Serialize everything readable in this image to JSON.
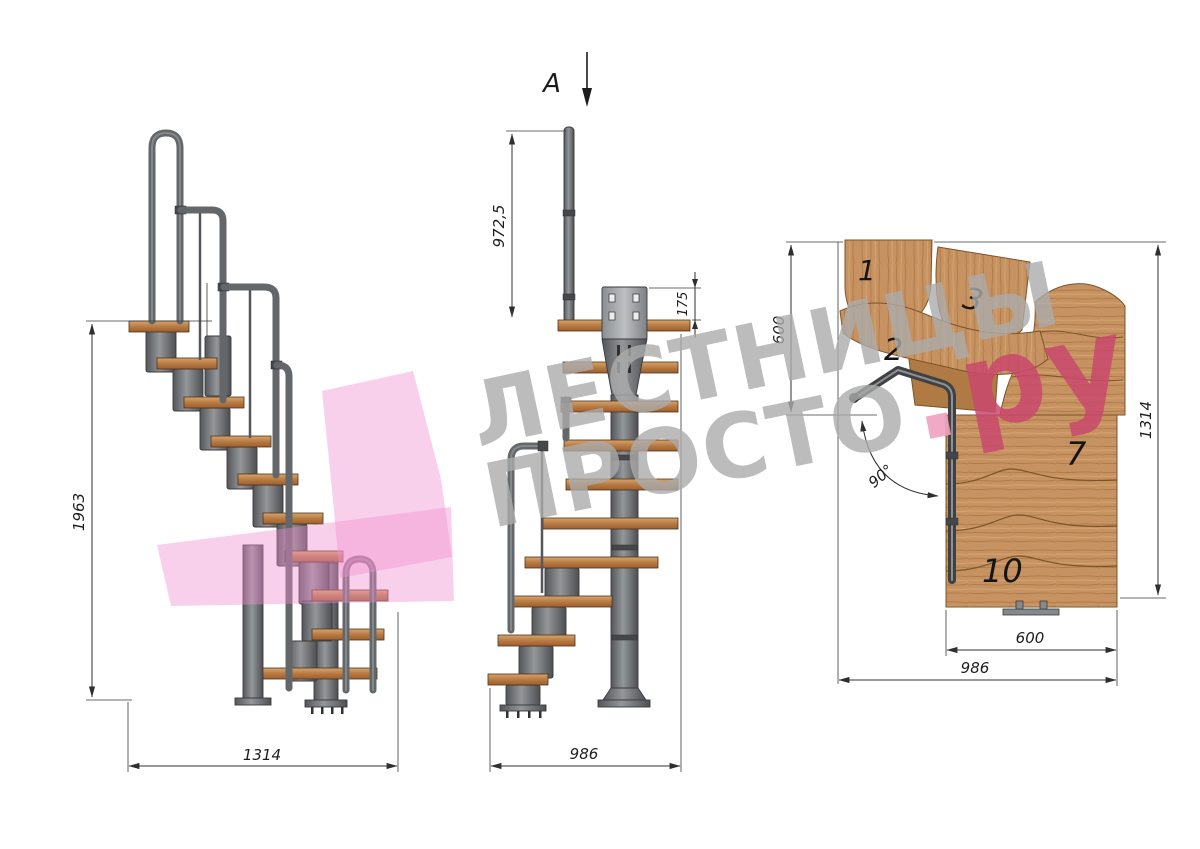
{
  "page": {
    "background": "#ffffff"
  },
  "section_label": {
    "letter": "А"
  },
  "watermark": {
    "line1": "ЛЕСТНИЦЫ",
    "line2": "ПРОСТО",
    "dot": ".",
    "suffix": "ру",
    "gray_color": "#ababab",
    "pink_color": "#c9486d",
    "dot_color": "#efa0c0",
    "arrow_color": "#f18fd0"
  },
  "side_view": {
    "dim_height": "1963",
    "dim_width": "1314"
  },
  "front_view": {
    "dim_handrail": "972,5",
    "dim_plate": "175",
    "dim_width": "986"
  },
  "plan_view": {
    "dim_left": "600",
    "dim_right": "1314",
    "dim_tread": "600",
    "dim_width": "986",
    "dim_angle": "90°",
    "steps": {
      "n1": "1",
      "n2": "2",
      "n3": "3",
      "n7": "7",
      "n10": "10"
    }
  },
  "colors": {
    "wood_light": "#d2a06a",
    "wood_dark": "#b5713a",
    "metal": "#6e7071",
    "line": "#2f2f2f"
  }
}
